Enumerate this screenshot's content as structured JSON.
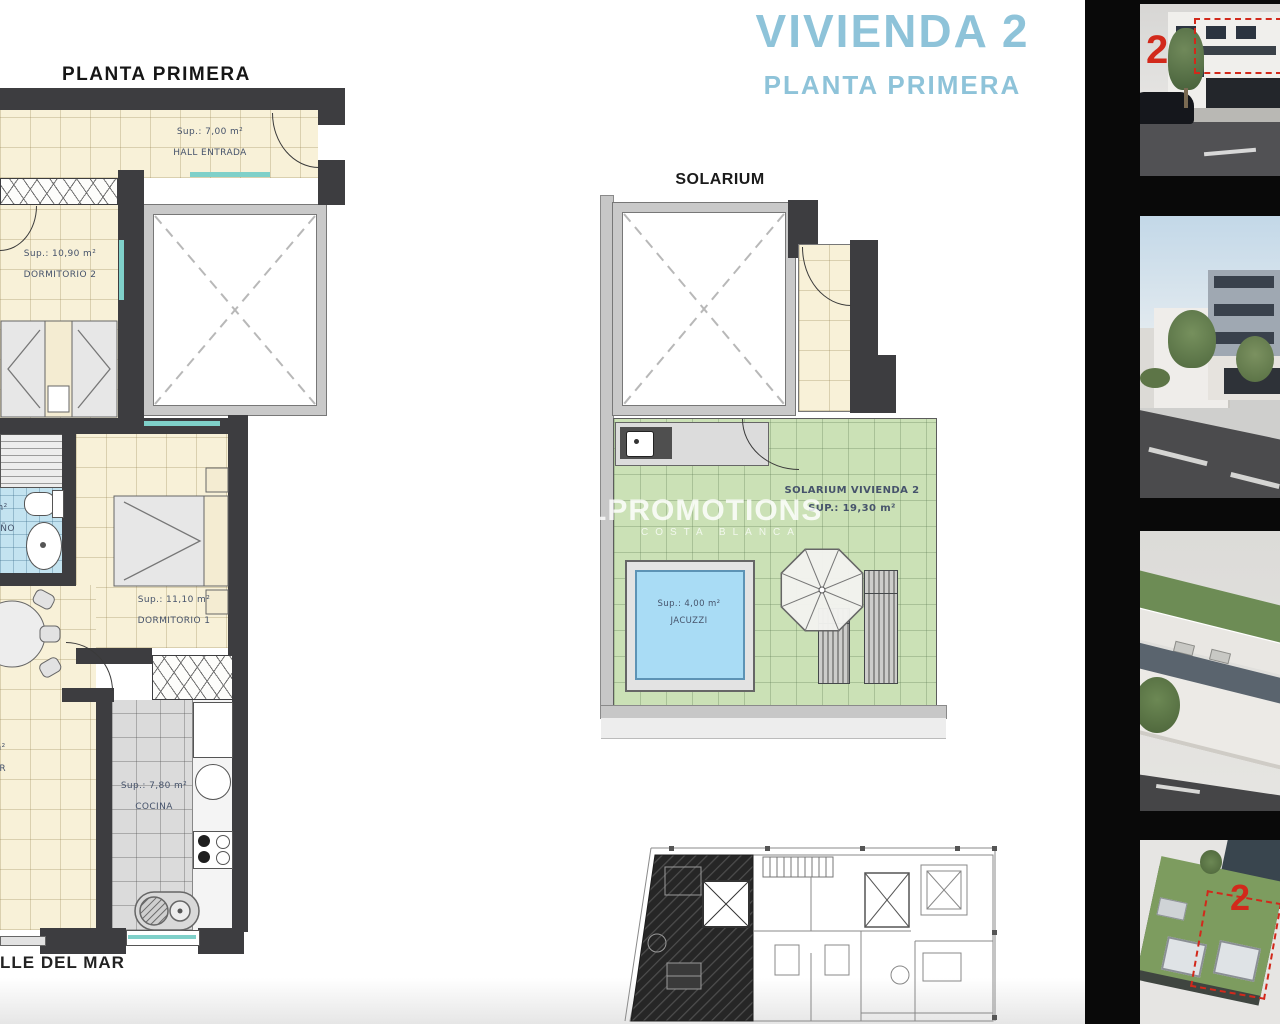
{
  "header": {
    "main_title": "VIVIENDA 2",
    "main_subtitle": "PLANTA PRIMERA",
    "title_color": "#8ec3d9"
  },
  "floor_plan": {
    "title": "PLANTA PRIMERA",
    "street_label": "LLE DEL MAR",
    "hall": {
      "sup": "Sup.: 7,00 m²",
      "label": "HALL ENTRADA"
    },
    "dormitorio2": {
      "sup": "Sup.: 10,90 m²",
      "label": "DORMITORIO 2"
    },
    "dormitorio1": {
      "sup": "Sup.: 11,10 m²",
      "label": "DORMITORIO 1"
    },
    "bano": {
      "sup": "m²",
      "label": "BAÑO"
    },
    "salon": {
      "sup_fragment": "m²",
      "label_fragment": "OR"
    },
    "cocina": {
      "sup": "Sup.: 7,80 m²",
      "label": "COCINA"
    }
  },
  "solarium": {
    "title": "SOLARIUM",
    "room_label": "SOLARIUM VIVIENDA 2",
    "room_sup": "SUP.: 19,30 m²",
    "jacuzzi": {
      "sup": "Sup.: 4,00 m²",
      "label": "JACUZZI"
    }
  },
  "watermark": {
    "line1": "LPROMOTIONS",
    "line2": "COSTA BLANCA"
  },
  "sidebar": {
    "images": [
      {
        "label": "street facade render",
        "marker": "2"
      },
      {
        "label": "street view render",
        "marker": ""
      },
      {
        "label": "aerial building render",
        "marker": ""
      },
      {
        "label": "aerial solarium render",
        "marker": "2"
      }
    ]
  },
  "colors": {
    "wall": "#3d3d40",
    "cream": "#f8f1d8",
    "bath_blue": "#c3e3f0",
    "kitchen_gray": "#dbdbdb",
    "terrace_green": "#cbe1b6",
    "jacuzzi_blue": "#a9dcf5",
    "label_text": "#46536b",
    "marker_red": "#d2291b"
  }
}
